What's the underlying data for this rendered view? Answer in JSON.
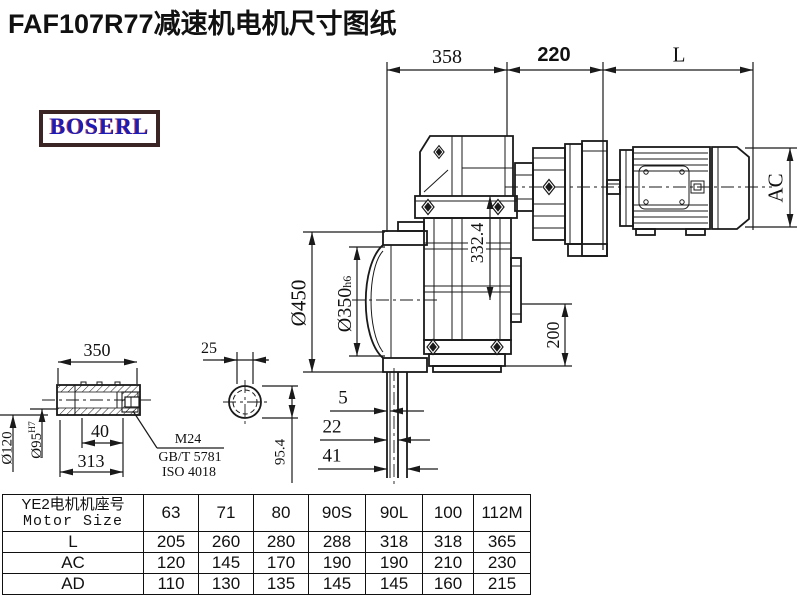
{
  "title": "FAF107R77减速机电机尺寸图纸",
  "logo": {
    "text": "BOSERL"
  },
  "drawing": {
    "dims": {
      "overall_gearbox": "358",
      "adapter_length": "220",
      "motor_length": "L",
      "motor_height": "AC",
      "flange_diameter": "Ø450",
      "spigot_diameter": "Ø350",
      "spigot_tolerance": "h6",
      "center_height": "332.4",
      "base_height": "200",
      "shaft_step_1": "5",
      "shaft_step_2": "22",
      "shaft_step_3": "41",
      "shaft_section_height": "95.4",
      "key_width": "25",
      "hollow_shaft_length": "350",
      "bore_step": "40",
      "bore_length": "313",
      "hub_diameter": "Ø120",
      "bore_diameter": "Ø95",
      "bore_tolerance": "H7",
      "thread_spec": "M24",
      "standard_1": "GB/T 5781",
      "standard_2": "ISO 4018"
    }
  },
  "table": {
    "header": {
      "row_title_cn": "YE2电机机座号",
      "row_title_en": "Motor Size",
      "sizes": [
        "63",
        "71",
        "80",
        "90S",
        "90L",
        "100",
        "112M"
      ]
    },
    "rows": [
      {
        "label": "L",
        "values": [
          "205",
          "260",
          "280",
          "288",
          "318",
          "318",
          "365"
        ]
      },
      {
        "label": "AC",
        "values": [
          "120",
          "145",
          "170",
          "190",
          "190",
          "210",
          "230"
        ]
      },
      {
        "label": "AD",
        "values": [
          "110",
          "130",
          "135",
          "145",
          "145",
          "160",
          "215"
        ]
      }
    ]
  }
}
